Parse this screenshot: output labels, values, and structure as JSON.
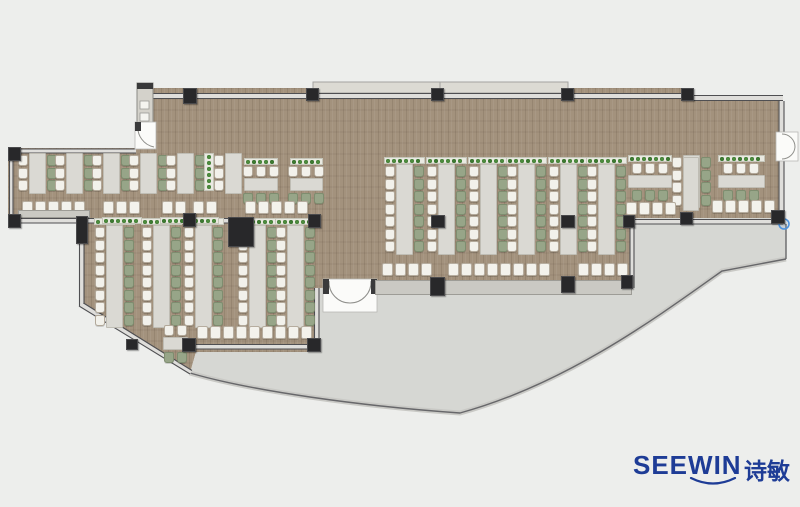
{
  "branding": {
    "wordmark": "SEEWIN",
    "cjk": "诗敏",
    "logo_color": "#1e3c96"
  },
  "palette": {
    "background": "#edeeec",
    "wood_floor": "#a3927d",
    "terrace": "#d6d7d3",
    "table": "#dad9d3",
    "chair_white": "#f2f1eb",
    "chair_green": "#97a588",
    "planter_green": "#4d8d3e",
    "wall": "#4f4f52",
    "column": "#28282a",
    "counter": "#cac9c3",
    "canopy": "#dcdad3",
    "door": "#fbfbf9",
    "marker_blue": "#4f93dd"
  },
  "floorplan": {
    "vclusters": [
      {
        "x": 18,
        "y": 155,
        "n": 3,
        "planter": false,
        "greens": true
      },
      {
        "x": 55,
        "y": 155,
        "n": 3,
        "planter": false,
        "greens": true
      },
      {
        "x": 92,
        "y": 155,
        "n": 3,
        "planter": false,
        "greens": true
      },
      {
        "x": 129,
        "y": 155,
        "n": 3,
        "planter": false,
        "greens": true
      },
      {
        "x": 166,
        "y": 155,
        "n": 3,
        "planter": false,
        "greens": true
      },
      {
        "x": 214,
        "y": 155,
        "n": 3,
        "planter": false,
        "greens": false
      },
      {
        "x": 95,
        "y": 227,
        "n": 8,
        "planter": true,
        "greens": true
      },
      {
        "x": 142,
        "y": 227,
        "n": 8,
        "planter": true,
        "greens": true
      },
      {
        "x": 184,
        "y": 227,
        "n": 8,
        "planter": true,
        "greens": true
      },
      {
        "x": 238,
        "y": 227,
        "n": 8,
        "planter": true,
        "greens": true
      },
      {
        "x": 276,
        "y": 227,
        "n": 8,
        "planter": true,
        "greens": true
      },
      {
        "x": 385,
        "y": 166,
        "n": 7,
        "planter": true,
        "greens": true
      },
      {
        "x": 427,
        "y": 166,
        "n": 7,
        "planter": true,
        "greens": true
      },
      {
        "x": 469,
        "y": 166,
        "n": 7,
        "planter": true,
        "greens": true
      },
      {
        "x": 507,
        "y": 166,
        "n": 7,
        "planter": true,
        "greens": true
      },
      {
        "x": 549,
        "y": 166,
        "n": 7,
        "planter": true,
        "greens": true
      },
      {
        "x": 587,
        "y": 166,
        "n": 7,
        "planter": true,
        "greens": true
      },
      {
        "x": 672,
        "y": 157,
        "n": 4,
        "planter": false,
        "greens": true
      }
    ],
    "hclusters": [
      {
        "x": 244,
        "y": 158,
        "w": 34,
        "n": 3,
        "planter": true
      },
      {
        "x": 290,
        "y": 158,
        "w": 33,
        "n": 3,
        "planter": true
      },
      {
        "x": 628,
        "y": 155,
        "w": 44,
        "n": 3,
        "planter": true
      },
      {
        "x": 718,
        "y": 155,
        "w": 47,
        "n": 3,
        "planter": true
      },
      {
        "x": 163,
        "y": 325,
        "w": 25,
        "n": 2,
        "planter": false
      }
    ],
    "stool_rows": [
      {
        "x": 22,
        "y": 201,
        "n": 5
      },
      {
        "x": 103,
        "y": 201,
        "n": 3
      },
      {
        "x": 162,
        "y": 201,
        "n": 2
      },
      {
        "x": 193,
        "y": 201,
        "n": 2
      },
      {
        "x": 245,
        "y": 201,
        "n": 5
      },
      {
        "x": 197,
        "y": 326,
        "n": 9
      },
      {
        "x": 382,
        "y": 263,
        "n": 4
      },
      {
        "x": 448,
        "y": 263,
        "n": 8
      },
      {
        "x": 578,
        "y": 263,
        "n": 4
      },
      {
        "x": 626,
        "y": 202,
        "n": 4
      },
      {
        "x": 712,
        "y": 200,
        "n": 5
      }
    ],
    "planters_h": [
      {
        "x": 102,
        "y": 217,
        "w": 40
      },
      {
        "x": 160,
        "y": 217,
        "w": 26
      },
      {
        "x": 192,
        "y": 217,
        "w": 27
      }
    ],
    "planters_v": [
      {
        "x": 204,
        "y": 153,
        "h": 38
      }
    ],
    "counters": [
      {
        "x": 18,
        "y": 210,
        "w": 72,
        "h": 8
      },
      {
        "x": 375,
        "y": 280,
        "w": 257,
        "h": 15
      }
    ],
    "tables": [
      {
        "x": 683,
        "y": 157,
        "w": 16,
        "h": 54
      }
    ],
    "columns": [
      [
        183,
        88,
        14,
        16
      ],
      [
        306,
        88,
        13,
        13
      ],
      [
        431,
        88,
        13,
        13
      ],
      [
        561,
        88,
        13,
        13
      ],
      [
        681,
        88,
        13,
        13
      ],
      [
        8,
        147,
        13,
        14
      ],
      [
        8,
        214,
        13,
        14
      ],
      [
        76,
        216,
        12,
        28
      ],
      [
        228,
        217,
        26,
        30
      ],
      [
        126,
        339,
        12,
        11
      ],
      [
        183,
        213,
        13,
        14
      ],
      [
        308,
        214,
        13,
        14
      ],
      [
        431,
        215,
        14,
        13
      ],
      [
        561,
        215,
        14,
        13
      ],
      [
        623,
        215,
        12,
        13
      ],
      [
        680,
        212,
        13,
        13
      ],
      [
        771,
        210,
        14,
        14
      ],
      [
        430,
        277,
        15,
        19
      ],
      [
        561,
        276,
        14,
        17
      ],
      [
        621,
        275,
        12,
        14
      ],
      [
        182,
        338,
        14,
        14
      ],
      [
        307,
        338,
        14,
        14
      ]
    ]
  }
}
